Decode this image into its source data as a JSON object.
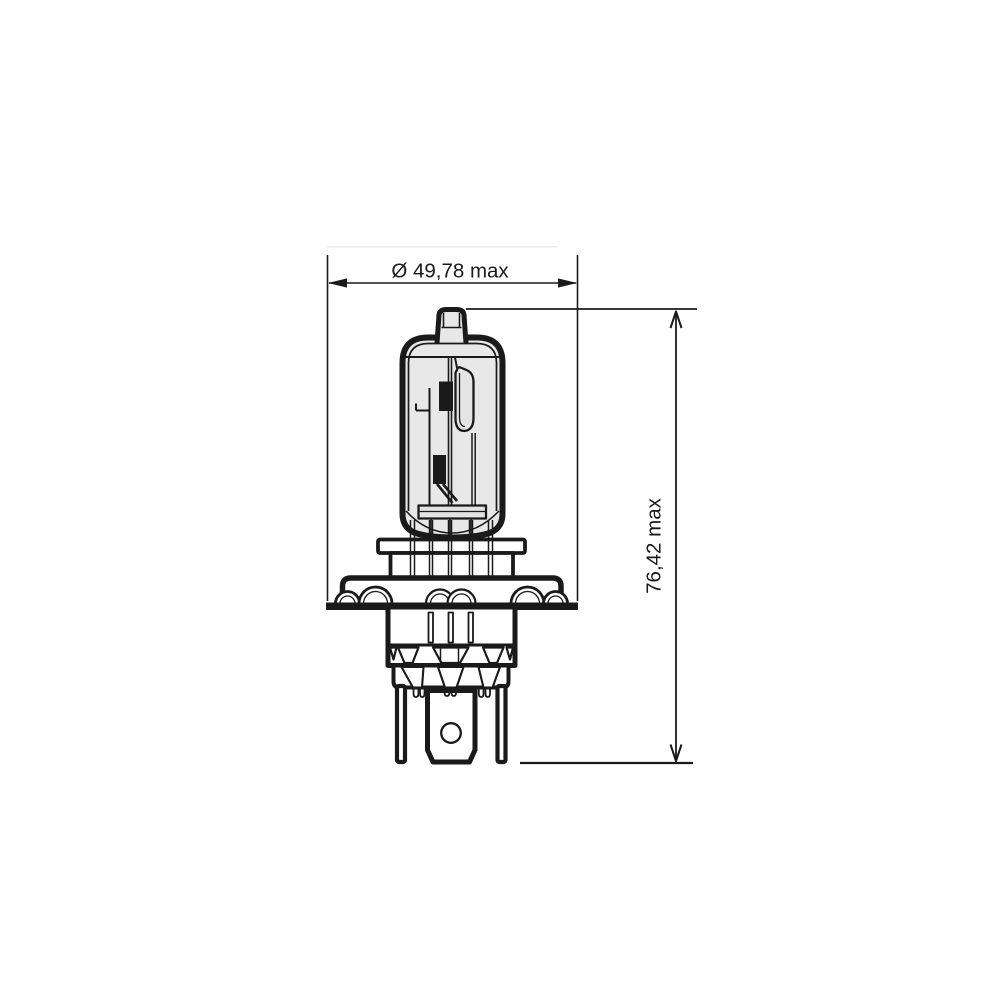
{
  "drawing": {
    "subject": "H4 halogen headlight bulb dimensional technical drawing",
    "labels": {
      "width": "Ø 49,78 max",
      "height": "76,42 max"
    },
    "colors": {
      "line": "#1a1a1a",
      "glass_fill": "#e8e8e8",
      "shield_fill": "#e4e4e4",
      "metal_fill": "#ffffff",
      "background": "#ffffff"
    }
  }
}
